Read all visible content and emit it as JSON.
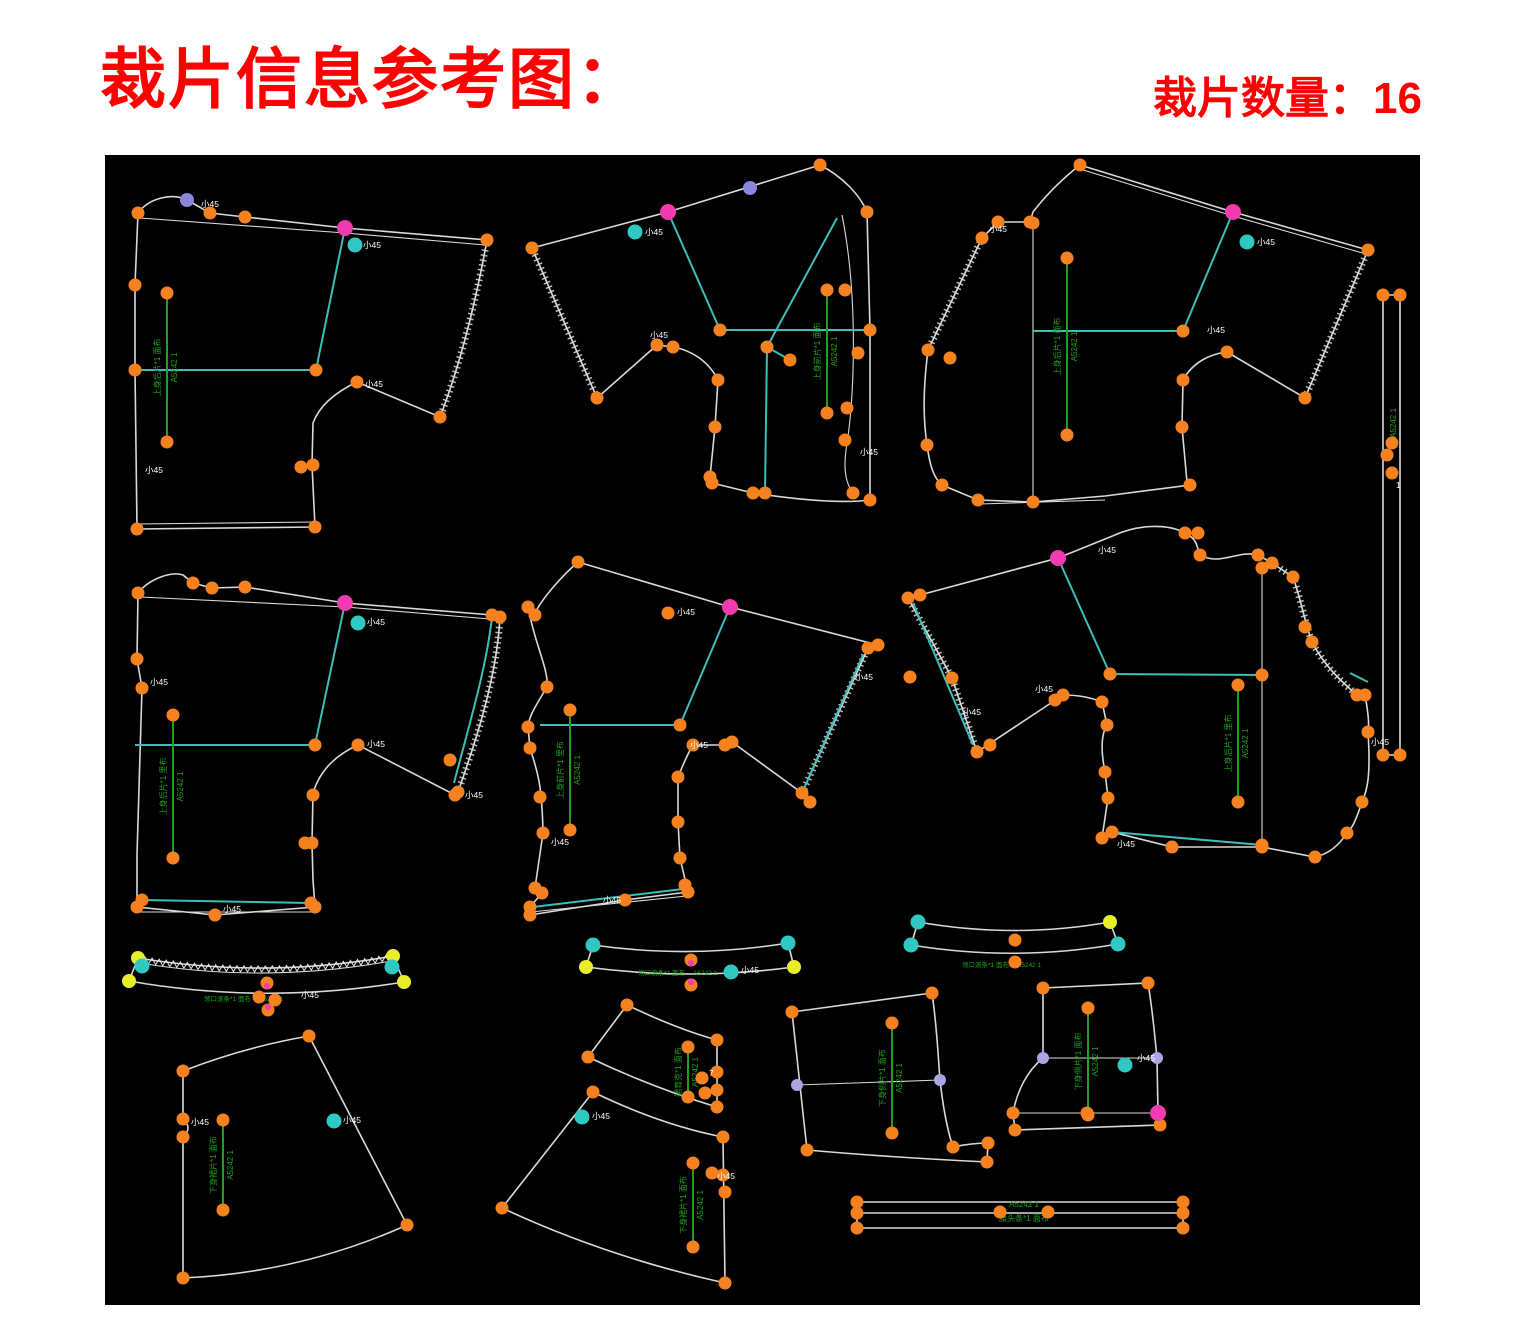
{
  "header": {
    "title": "裁片信息参考图：",
    "count_label": "裁片数量：16"
  },
  "colors": {
    "background": "#ffffff",
    "title_red": "#ff0000",
    "canvas": "#000000",
    "outline": "#d9d9d9",
    "point_orange": "#f5821f",
    "notch_pink": "#f23bb0",
    "notch_purple": "#8a86dd",
    "notch_cyan": "#2fc8c3",
    "notch_yellow": "#e8ef2a",
    "notch_lavender": "#aaa6e6",
    "internal_line": "#3fbdb9",
    "annotation_green": "#1ea11e",
    "small_text": "#ffffff"
  },
  "pieces": [
    {
      "id": "piece-1",
      "name": "上身后片(左上)",
      "desc_label": "上身后片*1 面布",
      "code_label": "A5242 1",
      "notch_label": "小45"
    },
    {
      "id": "piece-2",
      "name": "上身前片(上中)",
      "desc_label": "上身前片*1 面布",
      "code_label": "A5242 1",
      "notch_label": "小45"
    },
    {
      "id": "piece-3",
      "name": "上身后片(右上)",
      "desc_label": "上身后片*1 面布",
      "code_label": "A5242 1",
      "notch_label": "小45"
    },
    {
      "id": "piece-4",
      "name": "长嵌条(右侧)",
      "desc_label": "嵌条*1 面布",
      "code_label": "A5242 1",
      "notch_label": "1"
    },
    {
      "id": "piece-5",
      "name": "上身后片(中左)",
      "desc_label": "上身后片*1 里布",
      "code_label": "A5242 1",
      "notch_label": "小45"
    },
    {
      "id": "piece-6",
      "name": "上身前片(中中)",
      "desc_label": "上身前片*1 里布",
      "code_label": "A5242 1",
      "notch_label": "小45"
    },
    {
      "id": "piece-7",
      "name": "上身后片(中右)",
      "desc_label": "上身后片*1 里布",
      "code_label": "A5242 1",
      "notch_label": "小45"
    },
    {
      "id": "piece-8",
      "name": "领口滚条(左)",
      "desc_label": "领口滚条*1 面布",
      "code_label": "A5242 1",
      "notch_label": "小45"
    },
    {
      "id": "piece-9",
      "name": "领口滚条(中)",
      "desc_label": "领口滚条*1 面布",
      "code_label": "A5242 1",
      "notch_label": "小45"
    },
    {
      "id": "piece-10",
      "name": "领口滚条(右)",
      "desc_label": "领口滚条*1 面布",
      "code_label": "A5242 1",
      "notch_label": "小45"
    },
    {
      "id": "piece-11",
      "name": "下身裙片(左下)",
      "desc_label": "下身裙片*1 面布",
      "code_label": "A5242 1",
      "notch_label": "小45"
    },
    {
      "id": "piece-12",
      "name": "裙育克条(下中)",
      "desc_label": "裙育克*1 面布",
      "code_label": "A5242 1",
      "notch_label": "7"
    },
    {
      "id": "piece-13",
      "name": "下身裙片(下中)",
      "desc_label": "下身裙片*1 面布",
      "code_label": "A5242 1",
      "notch_label": "小45"
    },
    {
      "id": "piece-14",
      "name": "下身侧片(右下1)",
      "desc_label": "下身侧片*1 面布",
      "code_label": "A5242 1",
      "notch_label": "小45"
    },
    {
      "id": "piece-15",
      "name": "下身侧片(右下2)",
      "desc_label": "下身侧片*1 面布",
      "code_label": "A5242 1",
      "notch_label": "小45"
    },
    {
      "id": "piece-16",
      "name": "腰头条(底部)",
      "desc_label": "腰头条*1 面布",
      "code_label": "A5242 1",
      "notch_label": "小45"
    }
  ]
}
